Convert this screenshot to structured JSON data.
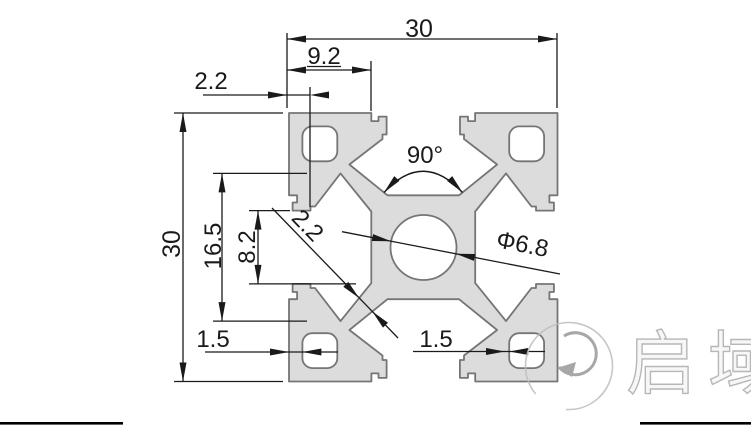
{
  "drawing": {
    "type": "technical-cross-section",
    "subject": "30x30 T-slot aluminium extrusion profile",
    "dimensions": {
      "width_top": "30",
      "slot_offset": "9.2",
      "lip_thickness": "2.2",
      "slot_angle": "90°",
      "height_left": "30",
      "cavity_width": "16.5",
      "slot_opening": "8.2",
      "web_thickness": "2.2",
      "center_hole": "Φ6.8",
      "hole_wall_left": "1.5",
      "hole_wall_right": "1.5"
    },
    "logo": {
      "brand_text": "启域",
      "mark": "Q-swoosh"
    }
  },
  "colors": {
    "profile_fill": "#dcdcdc",
    "profile_stroke": "#757575",
    "dimension": "#1a1a1a",
    "logo_gray": "#b9b9b9",
    "border": "#000000"
  }
}
